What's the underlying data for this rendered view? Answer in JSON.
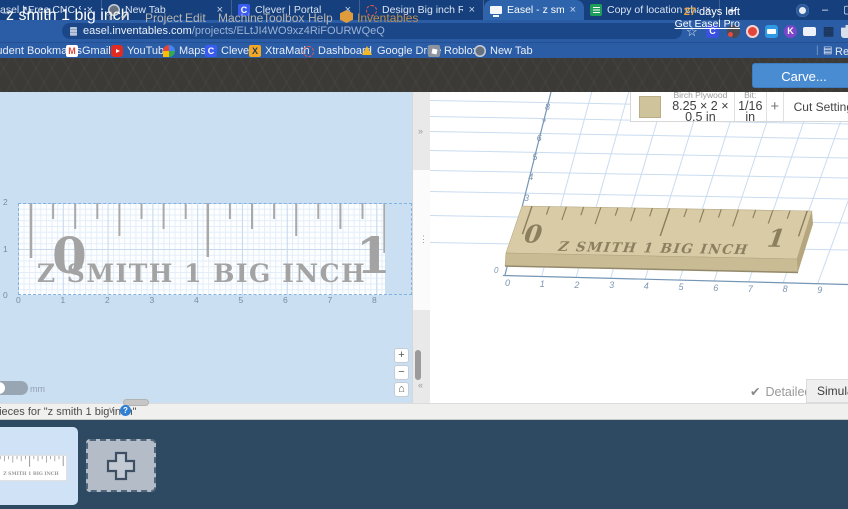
{
  "icons": {
    "close": "×",
    "plus": "+",
    "minimize": "–",
    "maximize": "▢",
    "back": "→",
    "refresh": "↻",
    "home": "⌂",
    "star": "☆",
    "check": "✔",
    "chevron_down": "∨",
    "help": "?",
    "collapse_right": "»",
    "collapse_left": "«",
    "kebab": "⋮",
    "reading_list_glyph": "▤",
    "grid_glyph": "▦",
    "separator": "|",
    "minus": "−",
    "k_letter": "K",
    "clever_letter": "C",
    "gmail_letter": "M",
    "xtramath_letter": "X"
  },
  "browser": {
    "tabs": [
      {
        "title": "Easel | Free CNC Software |",
        "icon": "easel",
        "active": false
      },
      {
        "title": "New Tab",
        "icon": "globe",
        "active": false
      },
      {
        "title": "Clever | Portal",
        "icon": "clever",
        "active": false
      },
      {
        "title": "Design Big inch Ruler on Eas",
        "icon": "dashed-circle",
        "active": false
      },
      {
        "title": "Easel - z smith 1 big inch",
        "icon": "monitor",
        "active": true
      },
      {
        "title": "Copy of location chart - Goo",
        "icon": "sheets",
        "active": false
      }
    ],
    "url_domain": "easel.inventables.com",
    "url_path": "/projects/ELtJI4WO9xz4RiFOURWQeQ",
    "bookmarks": [
      {
        "label": "Student Bookmarks",
        "icon": "folder"
      },
      {
        "label": "Gmail",
        "icon": "gmail"
      },
      {
        "label": "YouTube",
        "icon": "youtube"
      },
      {
        "label": "Maps",
        "icon": "maps"
      },
      {
        "label": "Clever",
        "icon": "clever"
      },
      {
        "label": "XtraMath",
        "icon": "xtramath"
      },
      {
        "label": "Dashboard",
        "icon": "dashboard"
      },
      {
        "label": "Google Drive",
        "icon": "drive"
      },
      {
        "label": "Roblox",
        "icon": "roblox"
      },
      {
        "label": "New Tab",
        "icon": "globe"
      }
    ],
    "reading_list": "Reading list"
  },
  "app_header": {
    "title": "z smith 1 big inch",
    "menus": [
      "Project",
      "Edit",
      "Machine",
      "Toolbox",
      "Help"
    ],
    "brand": "Inventables",
    "trial_days": "27",
    "trial_suffix": " days left",
    "upgrade_link": "Get Easel Pro",
    "carve_button": "Carve..."
  },
  "material_bar": {
    "material_name": "Birch Plywood",
    "material_size": "8.25 × 2 × 0.5 in",
    "bit_label": "Bit:",
    "bit_value": "1/16 in",
    "add_bit_button": "+",
    "cut_settings_button": "Cut Settings"
  },
  "design": {
    "ruler_zero": "0",
    "ruler_one": "1",
    "ruler_text": "Z SMITH 1 BIG INCH"
  },
  "canvas2d": {
    "x_axis": [
      "0",
      "1",
      "2",
      "3",
      "4",
      "5",
      "6",
      "7",
      "8"
    ],
    "y_axis": [
      "2",
      "1",
      "0"
    ],
    "unit_label": "mm"
  },
  "canvas3d": {
    "x_axis": [
      "0",
      "1",
      "2",
      "3",
      "4",
      "5",
      "6",
      "7",
      "8",
      "9"
    ],
    "y_axis": [
      "3",
      "4",
      "5",
      "6",
      "7",
      "8"
    ],
    "origin": "0",
    "detailed_label": "Detailed",
    "simulate_button": "Simulate"
  },
  "pieces_panel": {
    "title": "pieces for \"z smith 1 big inch\""
  }
}
